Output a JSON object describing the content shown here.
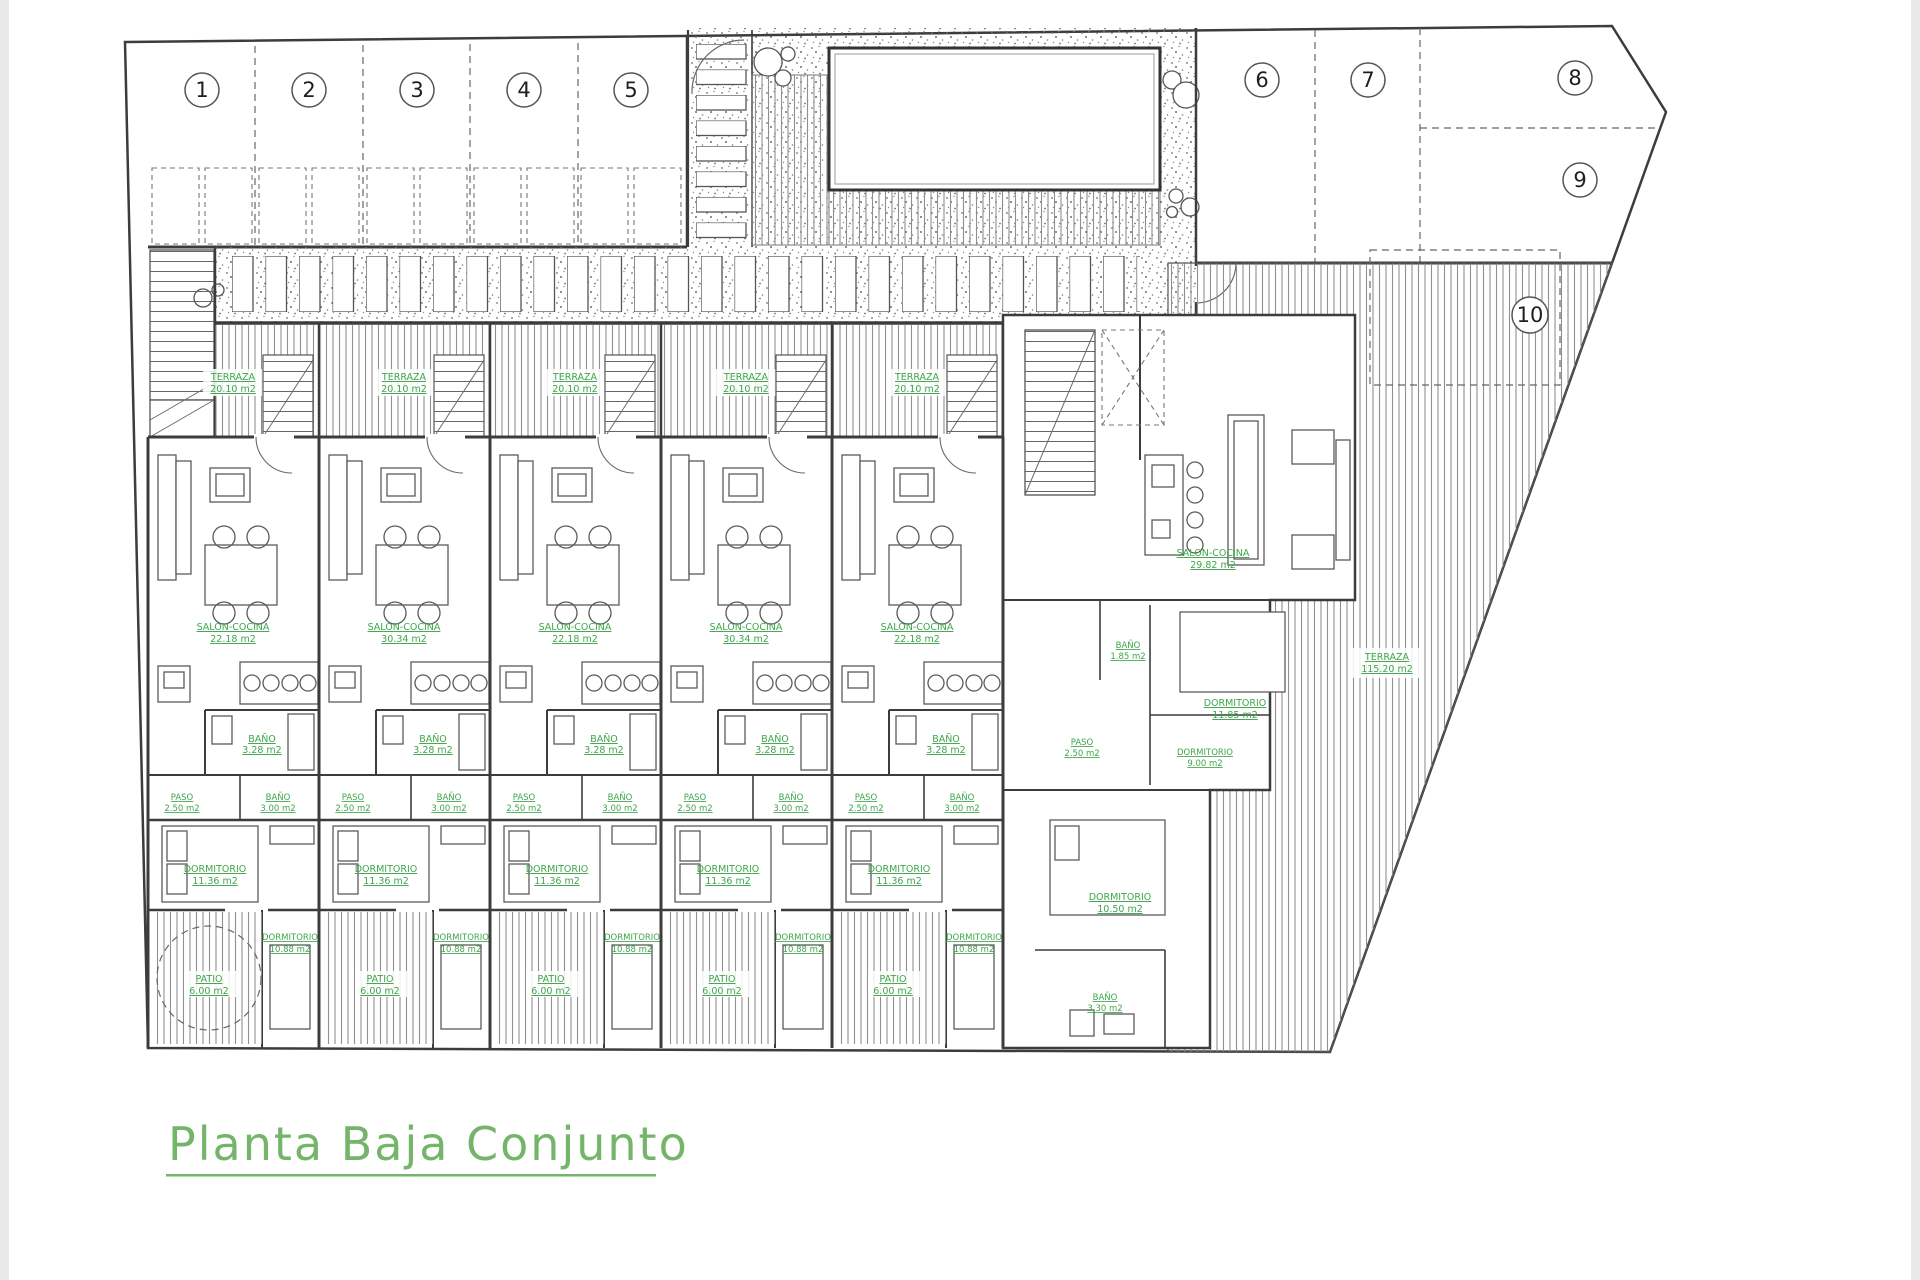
{
  "plan": {
    "title": "Planta Baja Conjunto",
    "parking": [
      "1",
      "2",
      "3",
      "4",
      "5",
      "6",
      "7",
      "8",
      "9",
      "10"
    ],
    "units": [
      {
        "terraza": [
          "TERRAZA",
          "20.10 m2"
        ],
        "salon": [
          "SALON-COCINA",
          "22.18 m2"
        ],
        "bano": [
          "BAÑO",
          "3.28 m2"
        ],
        "paso": [
          "PASO",
          "2.50 m2"
        ],
        "bano2": [
          "BAÑO",
          "3.00 m2"
        ],
        "dorm1": [
          "DORMITORIO",
          "11.36 m2"
        ],
        "dorm2": [
          "DORMITORIO",
          "10.88 m2"
        ],
        "patio": [
          "PATIO",
          "6.00 m2"
        ]
      },
      {
        "terraza": [
          "TERRAZA",
          "20.10 m2"
        ],
        "salon": [
          "SALON-COCINA",
          "30.34 m2"
        ],
        "bano": [
          "BAÑO",
          "3.28 m2"
        ],
        "paso": [
          "PASO",
          "2.50 m2"
        ],
        "bano2": [
          "BAÑO",
          "3.00 m2"
        ],
        "dorm1": [
          "DORMITORIO",
          "11.36 m2"
        ],
        "dorm2": [
          "DORMITORIO",
          "10.88 m2"
        ],
        "patio": [
          "PATIO",
          "6.00 m2"
        ]
      },
      {
        "terraza": [
          "TERRAZA",
          "20.10 m2"
        ],
        "salon": [
          "SALON-COCINA",
          "22.18 m2"
        ],
        "bano": [
          "BAÑO",
          "3.28 m2"
        ],
        "paso": [
          "PASO",
          "2.50 m2"
        ],
        "bano2": [
          "BAÑO",
          "3.00 m2"
        ],
        "dorm1": [
          "DORMITORIO",
          "11.36 m2"
        ],
        "dorm2": [
          "DORMITORIO",
          "10.88 m2"
        ],
        "patio": [
          "PATIO",
          "6.00 m2"
        ]
      },
      {
        "terraza": [
          "TERRAZA",
          "20.10 m2"
        ],
        "salon": [
          "SALON-COCINA",
          "30.34 m2"
        ],
        "bano": [
          "BAÑO",
          "3.28 m2"
        ],
        "paso": [
          "PASO",
          "2.50 m2"
        ],
        "bano2": [
          "BAÑO",
          "3.00 m2"
        ],
        "dorm1": [
          "DORMITORIO",
          "11.36 m2"
        ],
        "dorm2": [
          "DORMITORIO",
          "10.88 m2"
        ],
        "patio": [
          "PATIO",
          "6.00 m2"
        ]
      },
      {
        "terraza": [
          "TERRAZA",
          "20.10 m2"
        ],
        "salon": [
          "SALON-COCINA",
          "22.18 m2"
        ],
        "bano": [
          "BAÑO",
          "3.28 m2"
        ],
        "paso": [
          "PASO",
          "2.50 m2"
        ],
        "bano2": [
          "BAÑO",
          "3.00 m2"
        ],
        "dorm1": [
          "DORMITORIO",
          "11.36 m2"
        ],
        "dorm2": [
          "DORMITORIO",
          "10.88 m2"
        ],
        "patio": [
          "PATIO",
          "6.00 m2"
        ]
      }
    ],
    "end_unit": {
      "salon": [
        "SALON-COCINA",
        "29.82 m2"
      ],
      "dorm1": [
        "DORMITORIO",
        "11.85 m2"
      ],
      "bano1": [
        "BAÑO",
        "1.85 m2"
      ],
      "paso": [
        "PASO",
        "2.50 m2"
      ],
      "dorm2": [
        "DORMITORIO",
        "9.00 m2"
      ],
      "dorm3": [
        "DORMITORIO",
        "10.50 m2"
      ],
      "bano2": [
        "BAÑO",
        "3.30 m2"
      ],
      "terraza": [
        "TERRAZA",
        "115.20 m2"
      ]
    },
    "colors": {
      "label_green": "#3fa54b",
      "title_green": "#74b56a",
      "wall": "#3c3c3c"
    }
  }
}
